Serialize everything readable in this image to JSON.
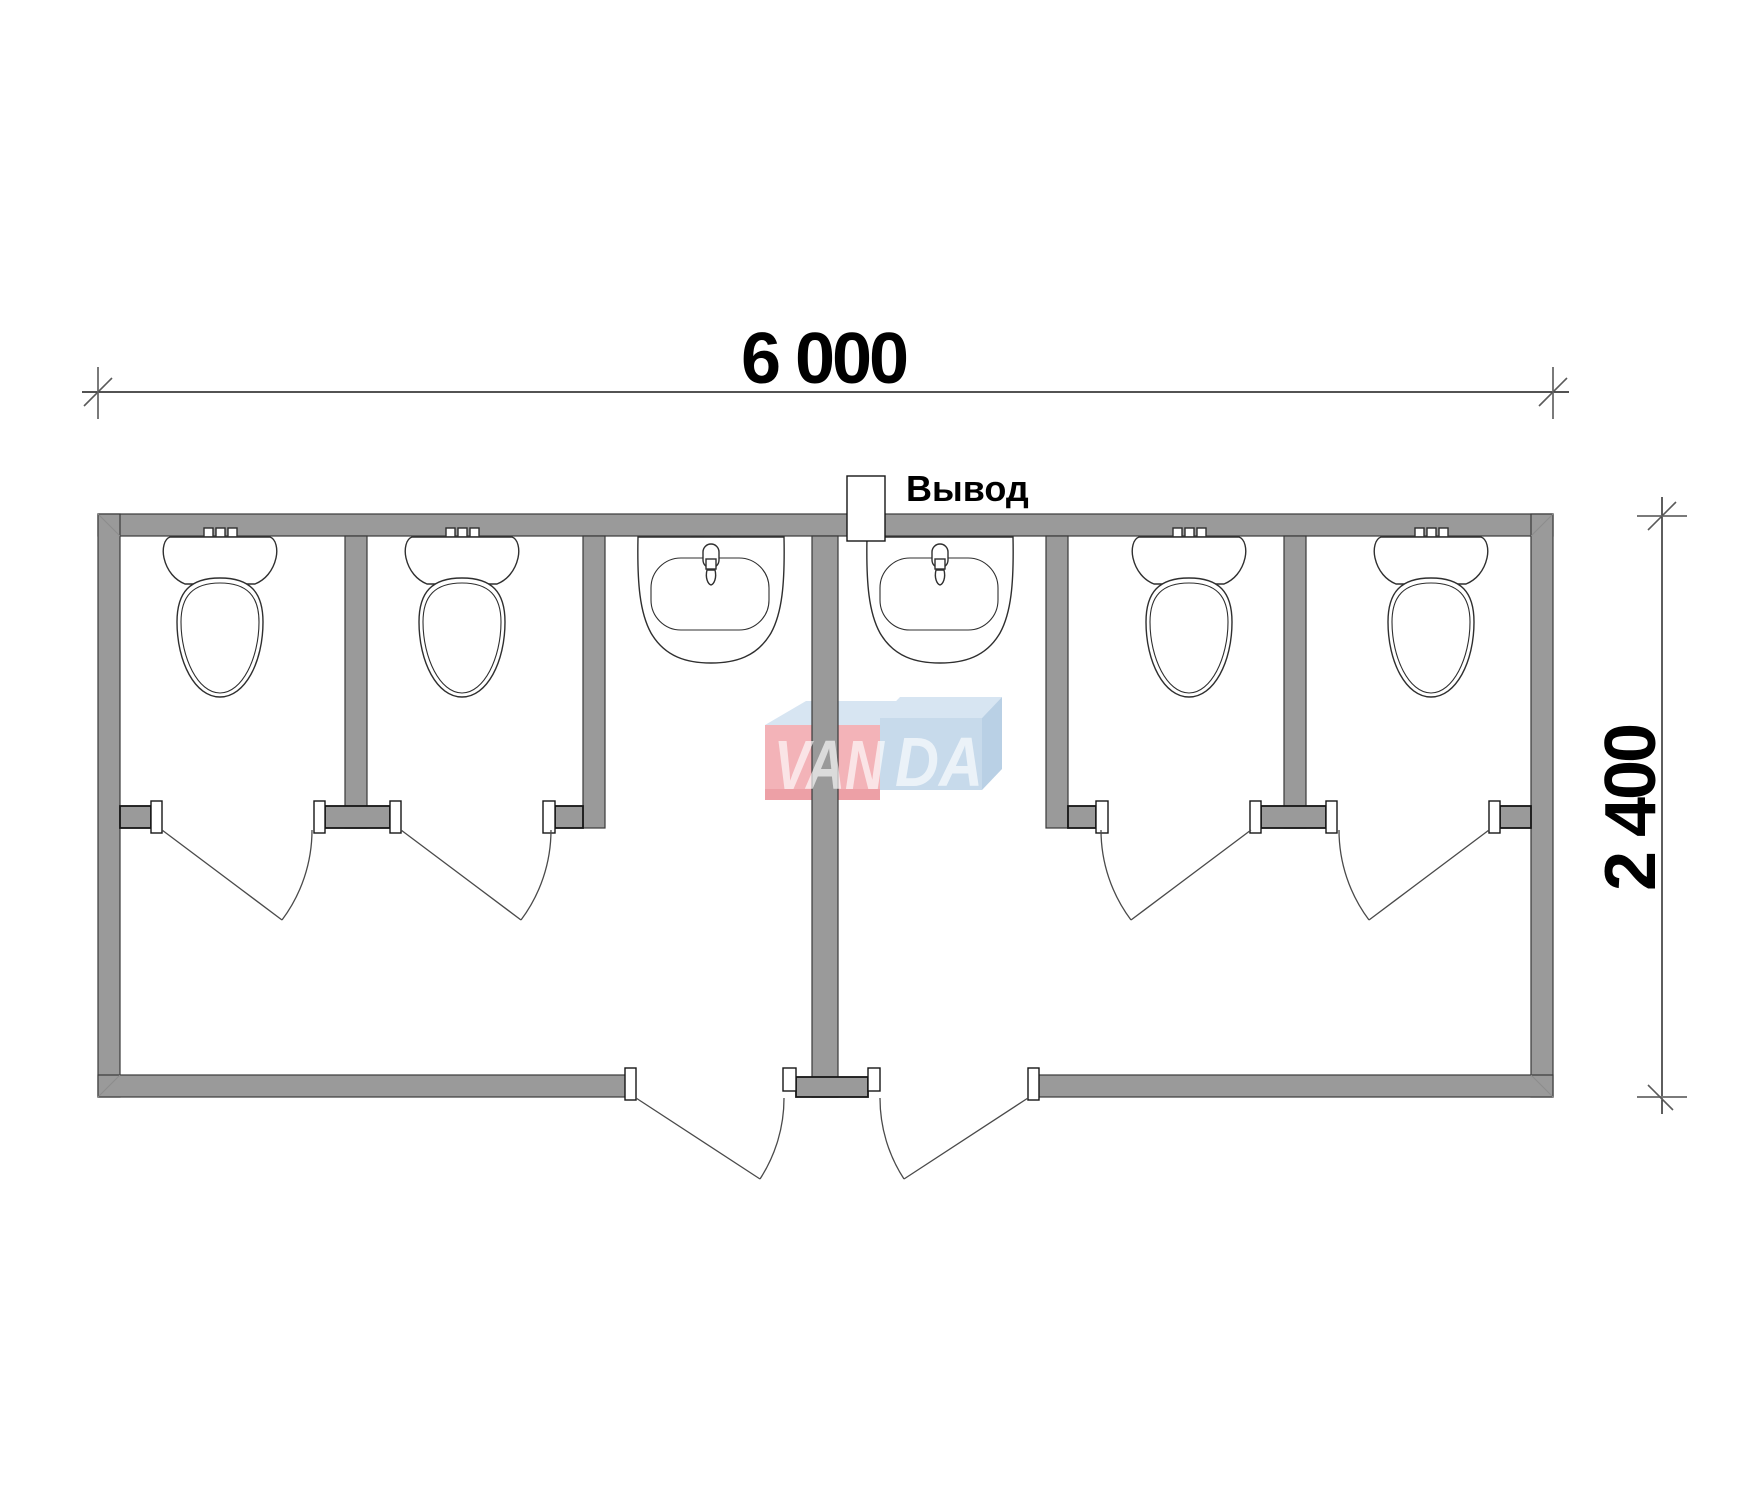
{
  "dimensions": {
    "width_label": "6 000",
    "height_label": "2 400"
  },
  "outlet": {
    "label": "Вывод"
  },
  "watermark": {
    "left": "VAN",
    "right": "DA",
    "full": "VANDA"
  },
  "fixtures": {
    "toilets": 4,
    "sinks": 2,
    "stall_doors": 4,
    "entrance_doors": 2
  },
  "colors": {
    "wall": "#9a9a9a",
    "outline": "#3a3a3a",
    "dimension_text": "#000000",
    "watermark_pink": "#f3b3b8",
    "watermark_pink_dark": "#eda0a6",
    "watermark_blue": "#c7daeb",
    "watermark_blue_side": "#b9d0e5",
    "watermark_blue_light": "#d7e5f2",
    "watermark_letters": "#ffffff"
  }
}
